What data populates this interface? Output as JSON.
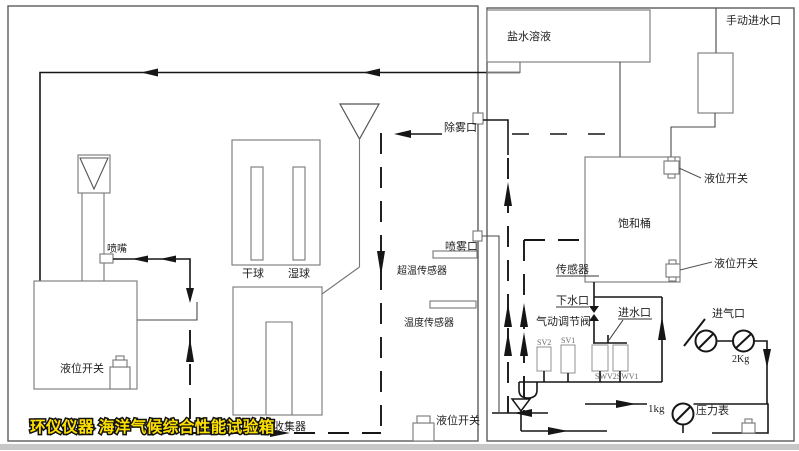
{
  "watermark": {
    "text": "环仪仪器 海洋气候综合性能试验箱",
    "color": "#ffe100"
  },
  "left_chamber": {
    "nozzle": "喷嘴",
    "tank_level_switch": "液位开关",
    "dry_bulb": "干球",
    "wet_bulb": "湿球",
    "collector": "盐雾收集器"
  },
  "partition": {
    "defog_port": "除雾口",
    "spray_port": "喷雾口",
    "overtemp_sensor": "超温传感器",
    "temp_sensor": "温度传感器",
    "bottom_level_switch": "液位开关"
  },
  "right_unit": {
    "salt_solution": "盐水溶液",
    "manual_water_inlet": "手动进水口",
    "saturator": "饱和桶",
    "level_switch_top": "液位开关",
    "level_switch_bottom": "液位开关",
    "sensor": "传感器",
    "drain_port": "下水口",
    "pneumatic_valve": "气动调节阀",
    "water_inlet": "进水口",
    "air_inlet": "进气口",
    "pressure_gauge": "压力表",
    "valves": {
      "sv2": "SV2",
      "sv1": "SV1",
      "swv": "SWV2SWV1"
    },
    "pressures": {
      "air": "2Kg",
      "gauge": "1kg"
    }
  }
}
